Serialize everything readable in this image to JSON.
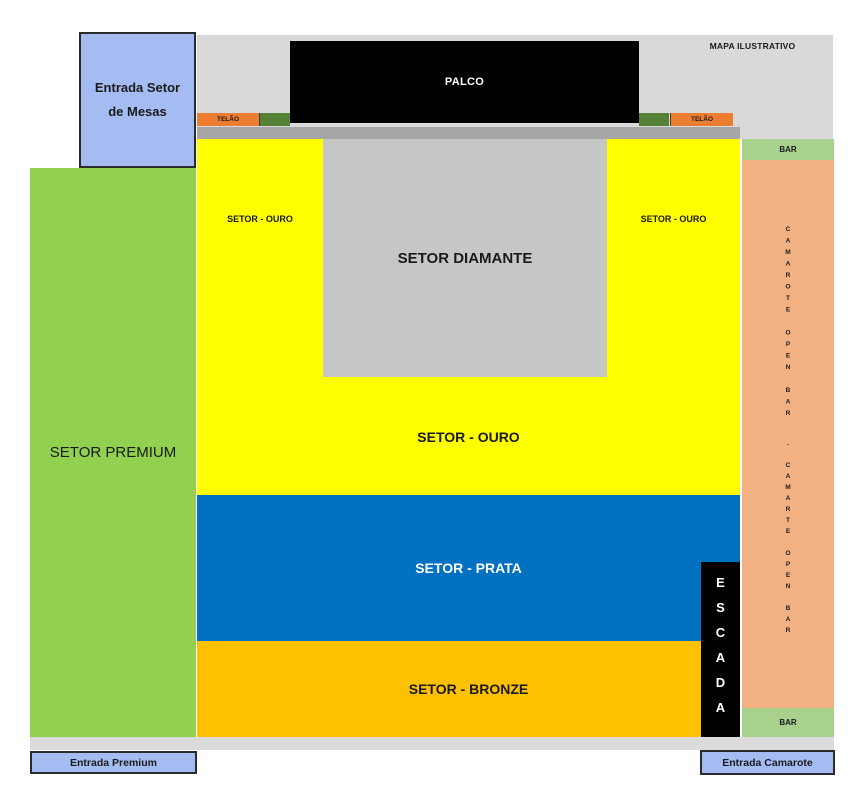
{
  "title_note": "MAPA ILUSTRATIVO",
  "stage": {
    "label": "PALCO",
    "color": "#000000"
  },
  "screens": {
    "left_label": "TELÃO",
    "right_label": "TELÃO",
    "color": "#ED7D31",
    "side_strip_color": "#538135"
  },
  "sectors": {
    "diamante": {
      "label": "SETOR DIAMANTE",
      "color": "#C6C6C6"
    },
    "ouro": {
      "label_main": "SETOR - OURO",
      "label_left_arm": "SETOR - OURO",
      "label_right_arm": "SETOR - OURO",
      "color": "#FFFF00"
    },
    "prata": {
      "label": "SETOR - PRATA",
      "color": "#0070C0"
    },
    "bronze": {
      "label": "SETOR - BRONZE",
      "color": "#FFC000"
    },
    "premium": {
      "label": "SETOR PREMIUM",
      "color": "#92D050"
    }
  },
  "camarote": {
    "bar_top_label": "BAR",
    "bar_bottom_label": "BAR",
    "vertical_label_1": "CAMAROTE OPEN BAR",
    "vertical_label_2": ". CAMARTE OPEN BAR",
    "color": "#F2B183",
    "bar_color": "#A9D18E"
  },
  "stairs": {
    "label": "ESCADA",
    "color": "#000000"
  },
  "entrances": {
    "mesas_line1": "Entrada Setor",
    "mesas_line2": "de Mesas",
    "premium_label": "Entrada Premium",
    "camarote_label": "Entrada Camarote",
    "box_color": "#A4BCF2"
  }
}
